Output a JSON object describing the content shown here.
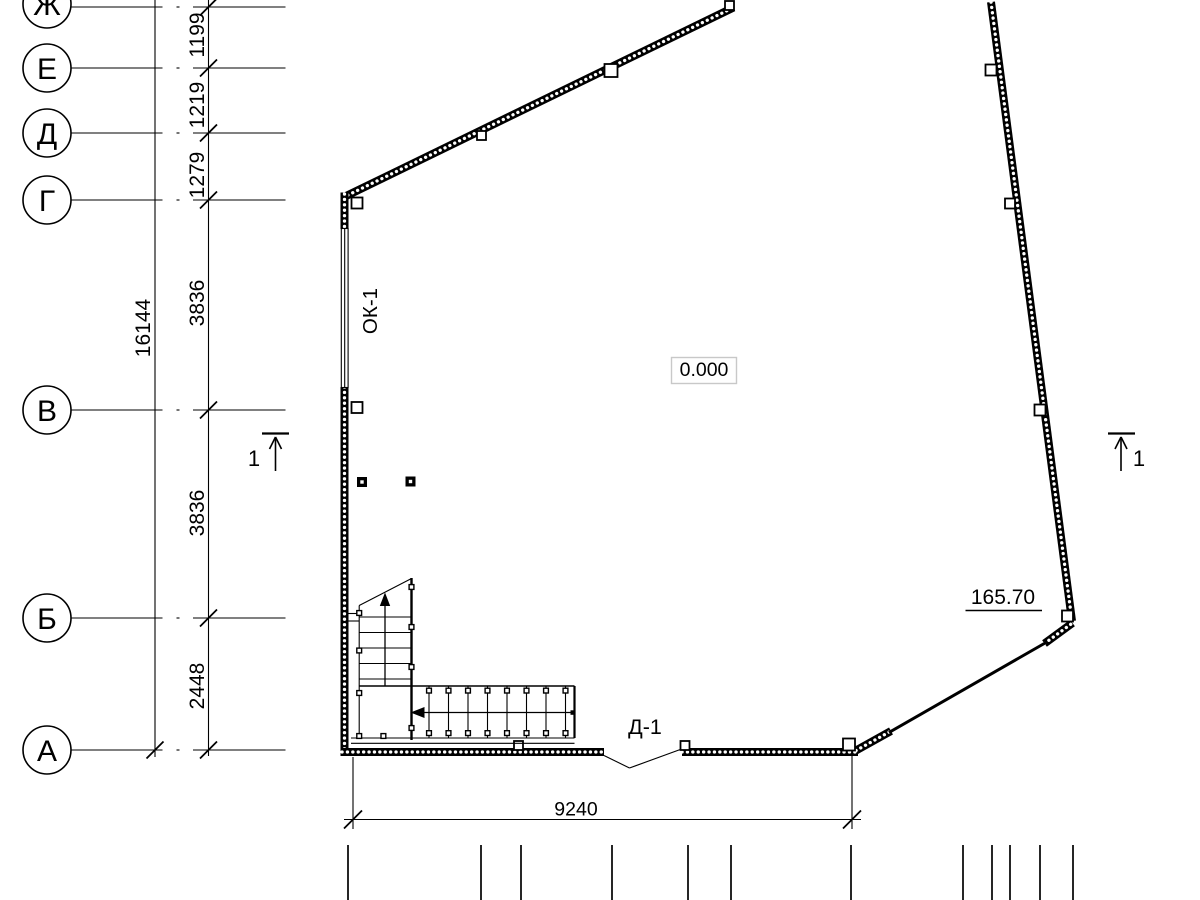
{
  "axes": {
    "letters": [
      "Ж",
      "Е",
      "Д",
      "Г",
      "В",
      "Б",
      "А"
    ]
  },
  "dimensions": {
    "left": [
      "1199",
      "1219",
      "1279",
      "3836",
      "3836",
      "2448"
    ],
    "total": "16144",
    "bottom_width": "9240"
  },
  "marks": {
    "window": "ОК-1",
    "door": "Д-1",
    "floor_elevation": "0.000",
    "corner_elevation": "165.70"
  },
  "sections": {
    "left": "1",
    "right": "1"
  },
  "colors": {
    "line": "#000000",
    "background": "#ffffff",
    "elevation_box_border": "#c8c8c8"
  }
}
